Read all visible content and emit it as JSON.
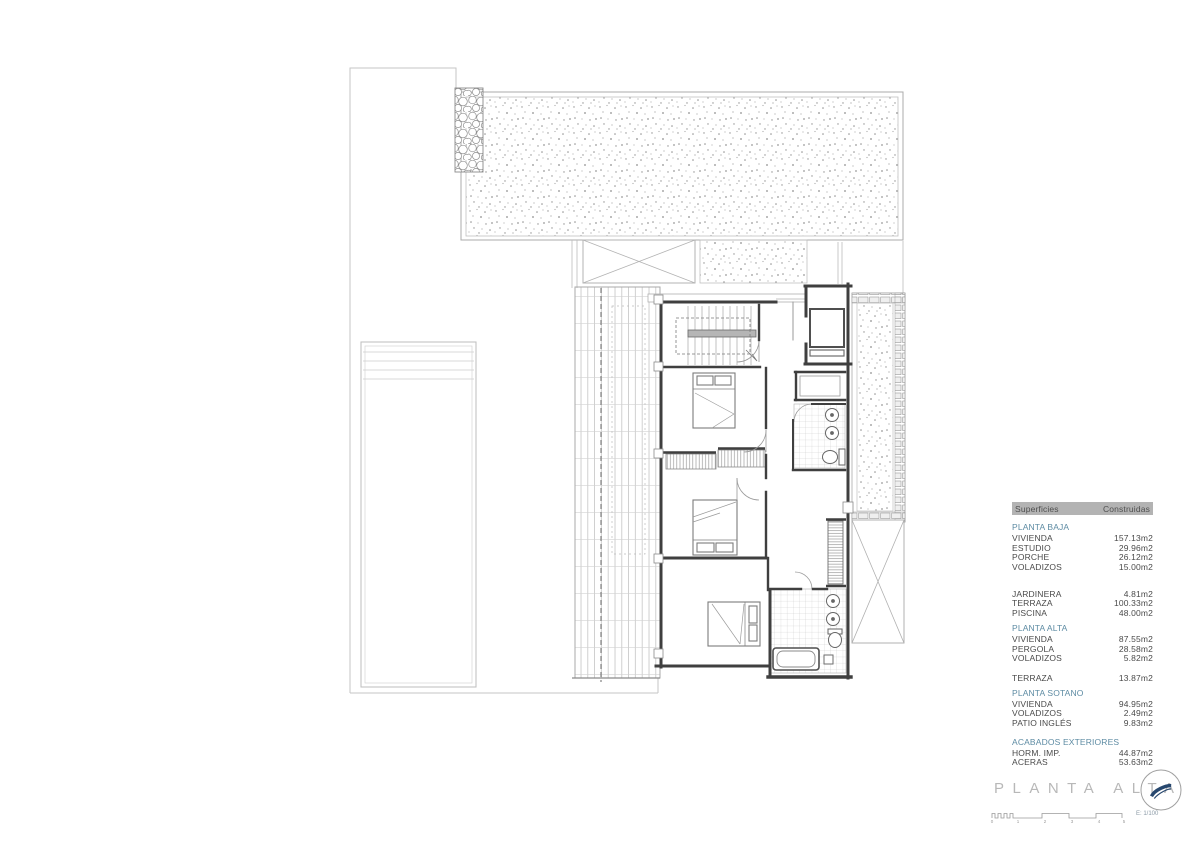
{
  "title": {
    "label": "PLANTA ALTA"
  },
  "scale": {
    "label": "E: 1/100",
    "ticks": [
      "0",
      "1",
      "2",
      "3",
      "4",
      "5"
    ]
  },
  "colors": {
    "accent_blue": "#5d8ba3",
    "header_gray": "#b3b3b3",
    "wall": "#3f3f3f",
    "light_line": "#c2c2c2"
  },
  "table": {
    "header": [
      "Superficies",
      "Construidas"
    ],
    "rows": [
      {
        "type": "section",
        "label": "PLANTA BAJA"
      },
      {
        "type": "item",
        "label": "VIVIENDA",
        "value": "157.13m2"
      },
      {
        "type": "item",
        "label": "ESTUDIO",
        "value": "29.96m2"
      },
      {
        "type": "item",
        "label": "PORCHE",
        "value": "26.12m2"
      },
      {
        "type": "item",
        "label": "VOLADIZOS",
        "value": "15.00m2"
      },
      {
        "type": "gap",
        "height": 17
      },
      {
        "type": "item",
        "label": "JARDINERA",
        "value": "4.81m2"
      },
      {
        "type": "item",
        "label": "TERRAZA",
        "value": "100.33m2"
      },
      {
        "type": "item",
        "label": "PISCINA",
        "value": "48.00m2"
      },
      {
        "type": "section",
        "label": "PLANTA ALTA"
      },
      {
        "type": "item",
        "label": "VIVIENDA",
        "value": "87.55m2"
      },
      {
        "type": "item",
        "label": "PERGOLA",
        "value": "28.58m2"
      },
      {
        "type": "item",
        "label": "VOLADIZOS",
        "value": "5.82m2"
      },
      {
        "type": "gap",
        "height": 10
      },
      {
        "type": "item",
        "label": "TERRAZA",
        "value": "13.87m2"
      },
      {
        "type": "section",
        "label": "PLANTA SOTANO"
      },
      {
        "type": "item",
        "label": "VIVIENDA",
        "value": "94.95m2"
      },
      {
        "type": "item",
        "label": "VOLADIZOS",
        "value": "2.49m2"
      },
      {
        "type": "item",
        "label": "PATIO INGLÉS",
        "value": "9.83m2"
      },
      {
        "type": "gap",
        "height": 4
      },
      {
        "type": "section",
        "label": "ACABADOS EXTERIORES"
      },
      {
        "type": "item",
        "label": "HORM. IMP.",
        "value": "44.87m2"
      },
      {
        "type": "item",
        "label": "ACERAS",
        "value": "53.63m2"
      }
    ]
  }
}
